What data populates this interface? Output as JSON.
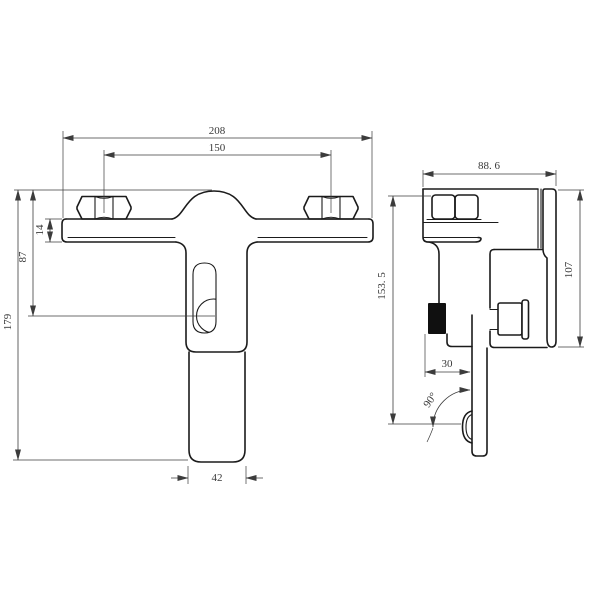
{
  "drawing_type": "technical-dimension-drawing",
  "subject": "wall-mounted faucet mixer, front and side orthographic views",
  "colors": {
    "background": "#ffffff",
    "outline": "#1b1b1b",
    "dimension": "#3c3c3c",
    "solid_component": "#101010"
  },
  "front_view": {
    "dimensions": {
      "overall_width": "208",
      "hole_spacing": "150",
      "bar_thickness": "14",
      "bar_to_outlet_center": "87",
      "overall_height": "179",
      "handle_width": "42"
    }
  },
  "side_view": {
    "dimensions": {
      "depth": "88. 6",
      "total_height": "153. 5",
      "handle_length": "107",
      "outlet_offset": "30",
      "swivel_angle": "90°"
    }
  }
}
